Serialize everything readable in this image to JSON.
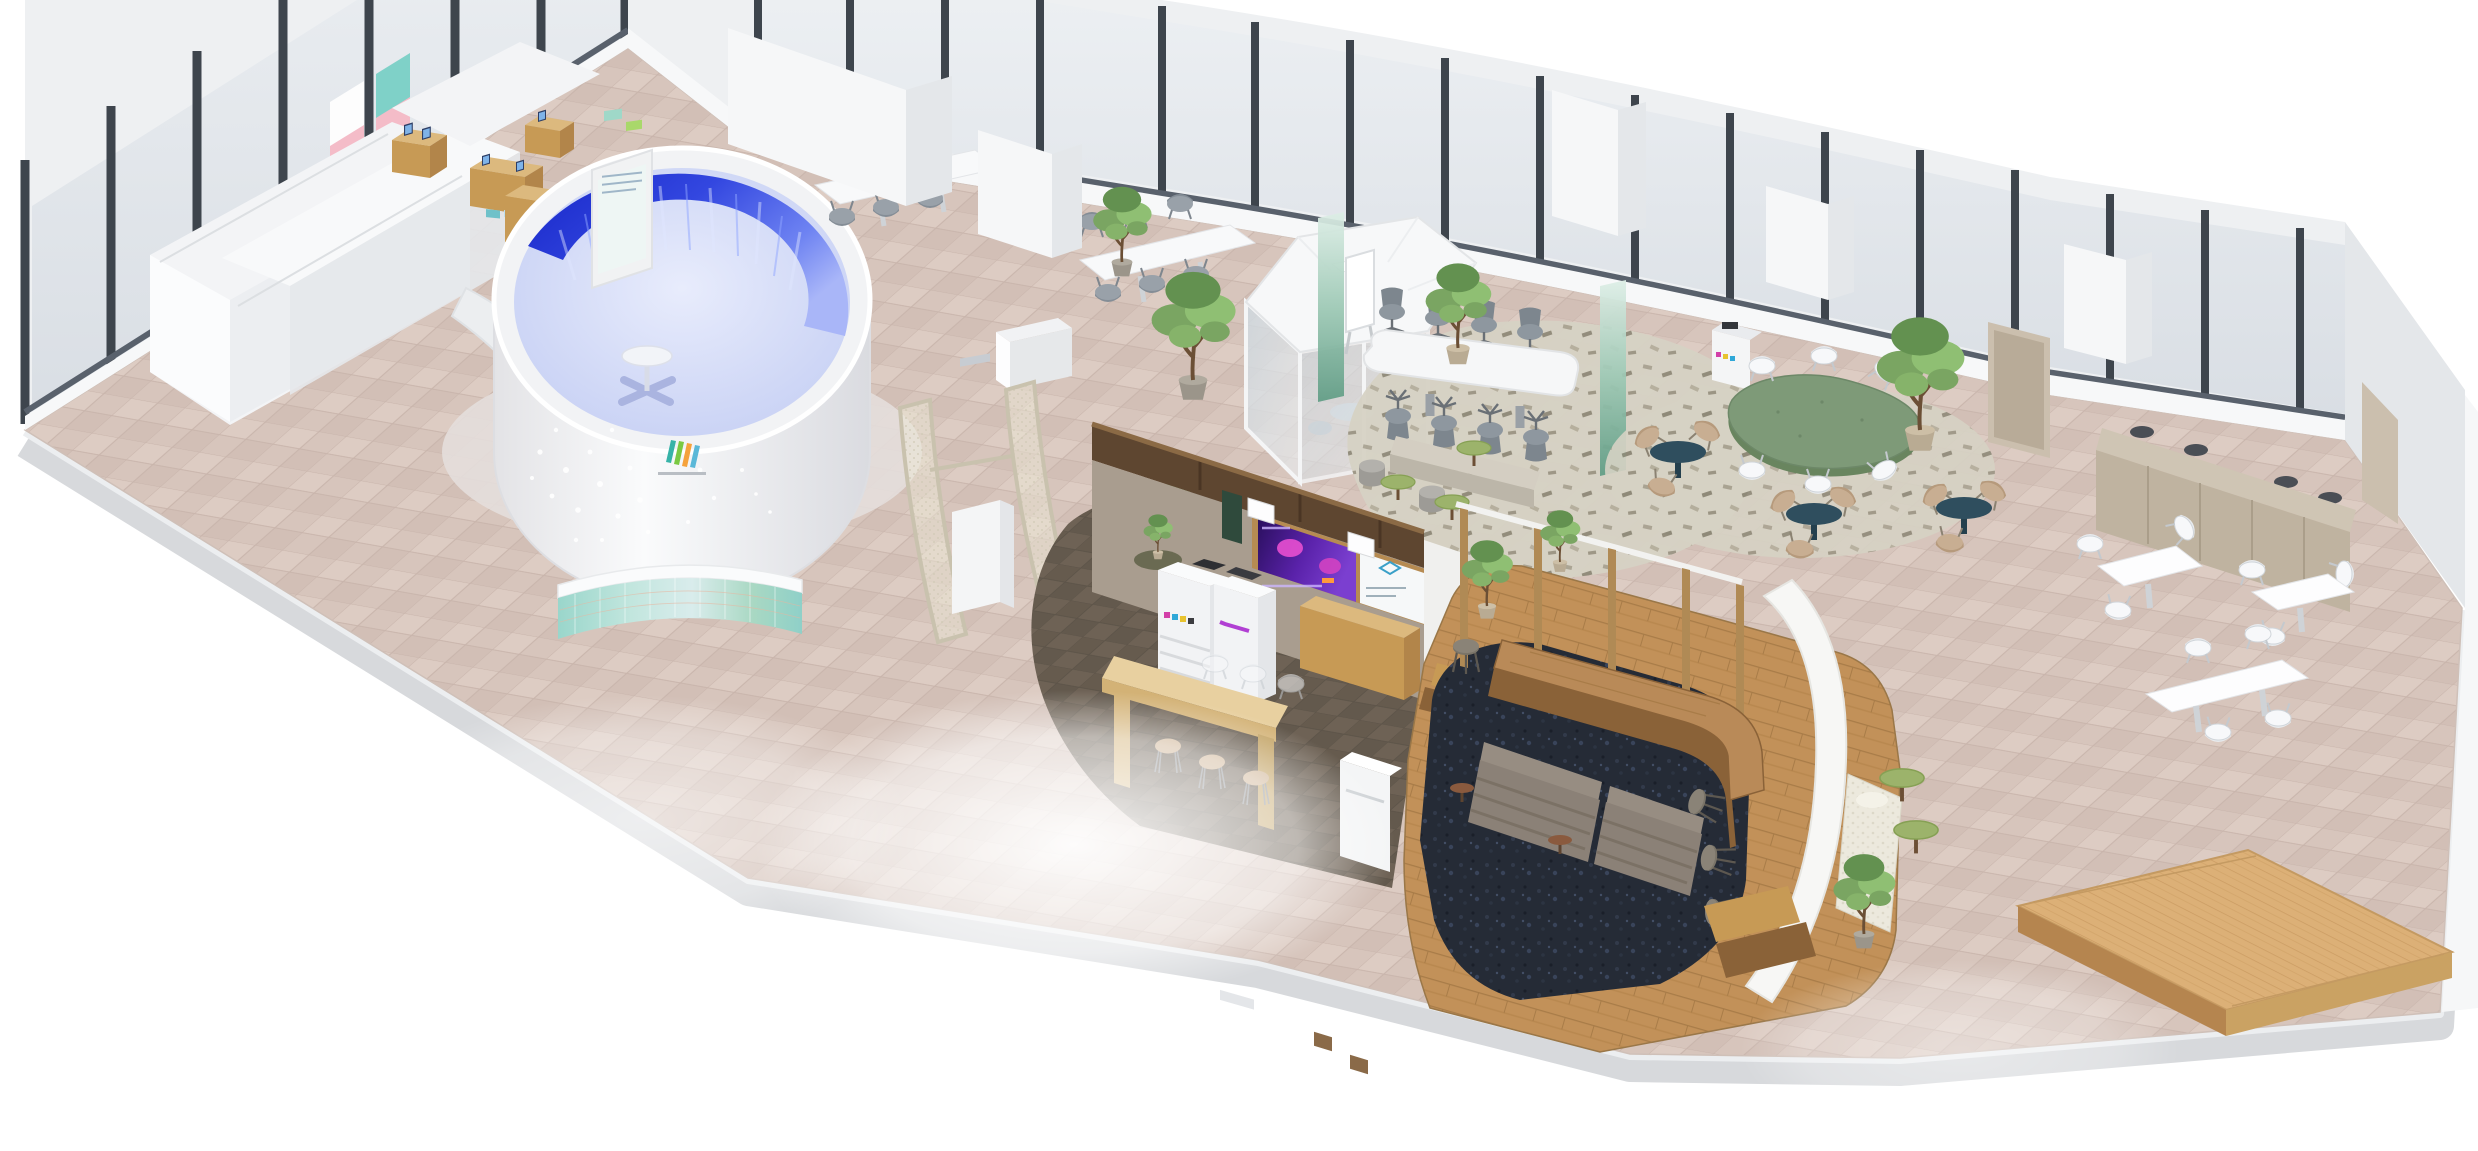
{
  "scene": {
    "title": "Isometric 3D render of an office floor plan",
    "view": "cutaway isometric bird's-eye view",
    "background": "white"
  },
  "colors": {
    "page-bg": "#ffffff",
    "floor-tile": "#d7c5bc",
    "floor-tile-alt": "#ddccc3",
    "floor-grout": "#c9b5ac",
    "slab-face": "#d7d9dc",
    "wall": "#eef0f2",
    "wall-side": "#e4e7ea",
    "wall-skirt": "#f7f8f9",
    "window-glass": "#dfe3e8",
    "window-mullion": "#3e454d",
    "window-sill": "#59616c",
    "carpet-brown": "#6e6255",
    "carpet-navy": "#252b36",
    "rug-speckle": "#d6d2c4",
    "wood-light": "#dcb97e",
    "wood-mid": "#c79a55",
    "wood-side": "#b2854a",
    "wood-dark": "#8a6238",
    "plank-floor": "#c29159",
    "stage-wood": "#dcb077",
    "green-table": "#7e9a78",
    "green-table-edge": "#69855f",
    "teal-table": "#2f4e5e",
    "lilypad-green": "#9cb36b",
    "sofa-gray": "#8b8177",
    "sofa-back": "#978d82",
    "chair-gray": "#99a1a9",
    "chair-white": "#f7f8fa",
    "chair-beige": "#c8ae92",
    "plant-green": "#7aa562",
    "screen-blue": "#3347e0",
    "cylinder-floor": "#ccd4f1",
    "iridescent-teal": "#9ad6cb",
    "curtain-green": "#6fae97",
    "dashboard-purple": "#5a22aa",
    "dashboard-magenta": "#e84fd0",
    "taupe-wall": "#a99d8f",
    "door-beige": "#cbbfae",
    "logo-teal": "#37b3a8",
    "logo-green": "#7ac943",
    "logo-orange": "#f5a23c"
  },
  "zones": [
    {
      "id": "backstage-rooms",
      "label": "white back-of-house rooms"
    },
    {
      "id": "showroom",
      "label": "product display stands with devices"
    },
    {
      "id": "immersive-cylinder",
      "label": "circular immersive blue display room"
    },
    {
      "id": "window-meeting-tables",
      "label": "white meeting tables along windows"
    },
    {
      "id": "entry-gate",
      "label": "curved mesh entry partition with kiosk"
    },
    {
      "id": "meeting-pod",
      "label": "hexagonal glass meeting pod"
    },
    {
      "id": "conference-area",
      "label": "open conference table for eight"
    },
    {
      "id": "lily-bench",
      "label": "bench with green poseur tables and stools"
    },
    {
      "id": "green-table-lounge",
      "label": "organic green table with white chairs"
    },
    {
      "id": "teal-cafe-tables",
      "label": "round teal tables with beige chairs"
    },
    {
      "id": "print-room",
      "label": "print room with copiers and dashboard screen"
    },
    {
      "id": "work-cafe",
      "label": "work cafe bar counter on wood platform"
    },
    {
      "id": "sofa-lounge",
      "label": "sofa lounge on navy carpet"
    },
    {
      "id": "dining-area",
      "label": "white dining tables and window counter"
    },
    {
      "id": "stage",
      "label": "wooden stage platform"
    }
  ],
  "counts": {
    "conference_chairs": 8,
    "cafe_bar_stools": 7,
    "copiers": 3,
    "dining_tables": 3,
    "teal_tables": 3,
    "potted_trees": 8,
    "wall_posters": 6
  },
  "logo": {
    "shape": "m-mark",
    "bar_colors": [
      "#37b3a8",
      "#7ac943",
      "#f5a23c"
    ]
  }
}
